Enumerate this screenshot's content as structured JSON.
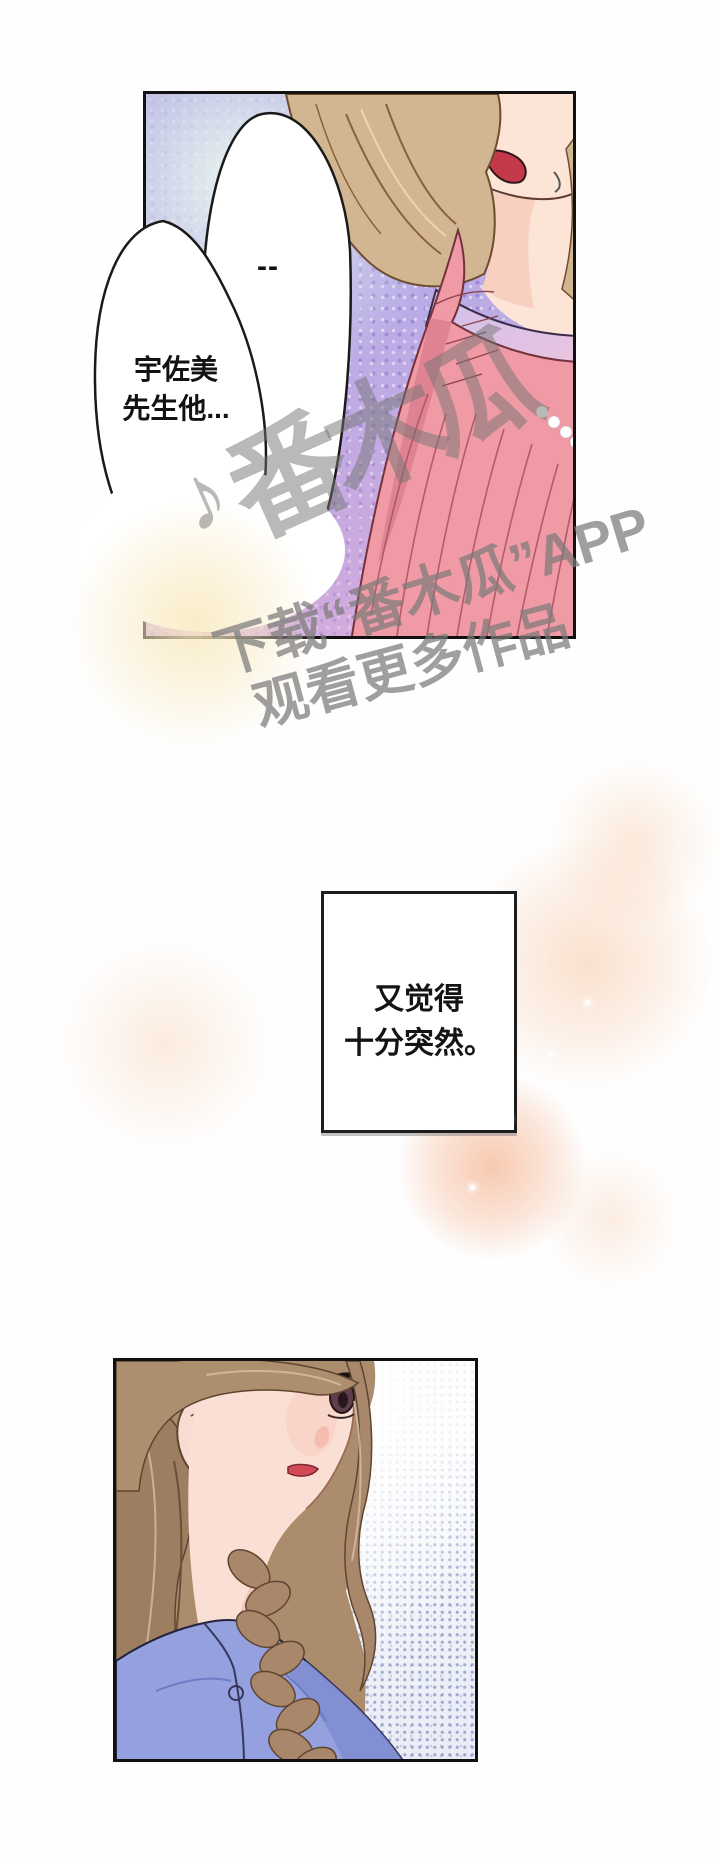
{
  "panel1": {
    "bubble_dash": "--",
    "bubble_name": {
      "line1": "宇佐美",
      "line2": "先生他..."
    },
    "colors": {
      "background_purple": "#b9abe6",
      "pink_top": "#ef9aa4",
      "hair_light_brown": "#d2b691",
      "mouth_red": "#c3394a",
      "glow_yellow": "#f9e9be"
    }
  },
  "watermark": {
    "note_icon": "♪",
    "stamp_text": "番木瓜",
    "line1": "下载“番木瓜”APP",
    "line2": "观看更多作品",
    "color_gray": "#7a7a7a"
  },
  "caption": {
    "line1": "又觉得",
    "line2": "十分突然。"
  },
  "panel2": {
    "colors": {
      "shirt_blue": "#94a1de",
      "hair_brown": "#a8876a",
      "halftone_blue": "#5264a0",
      "lips_red": "#d24a55"
    }
  },
  "decor": {
    "blob_peach": "#f7c49e",
    "blob_orange": "#f39e70"
  }
}
